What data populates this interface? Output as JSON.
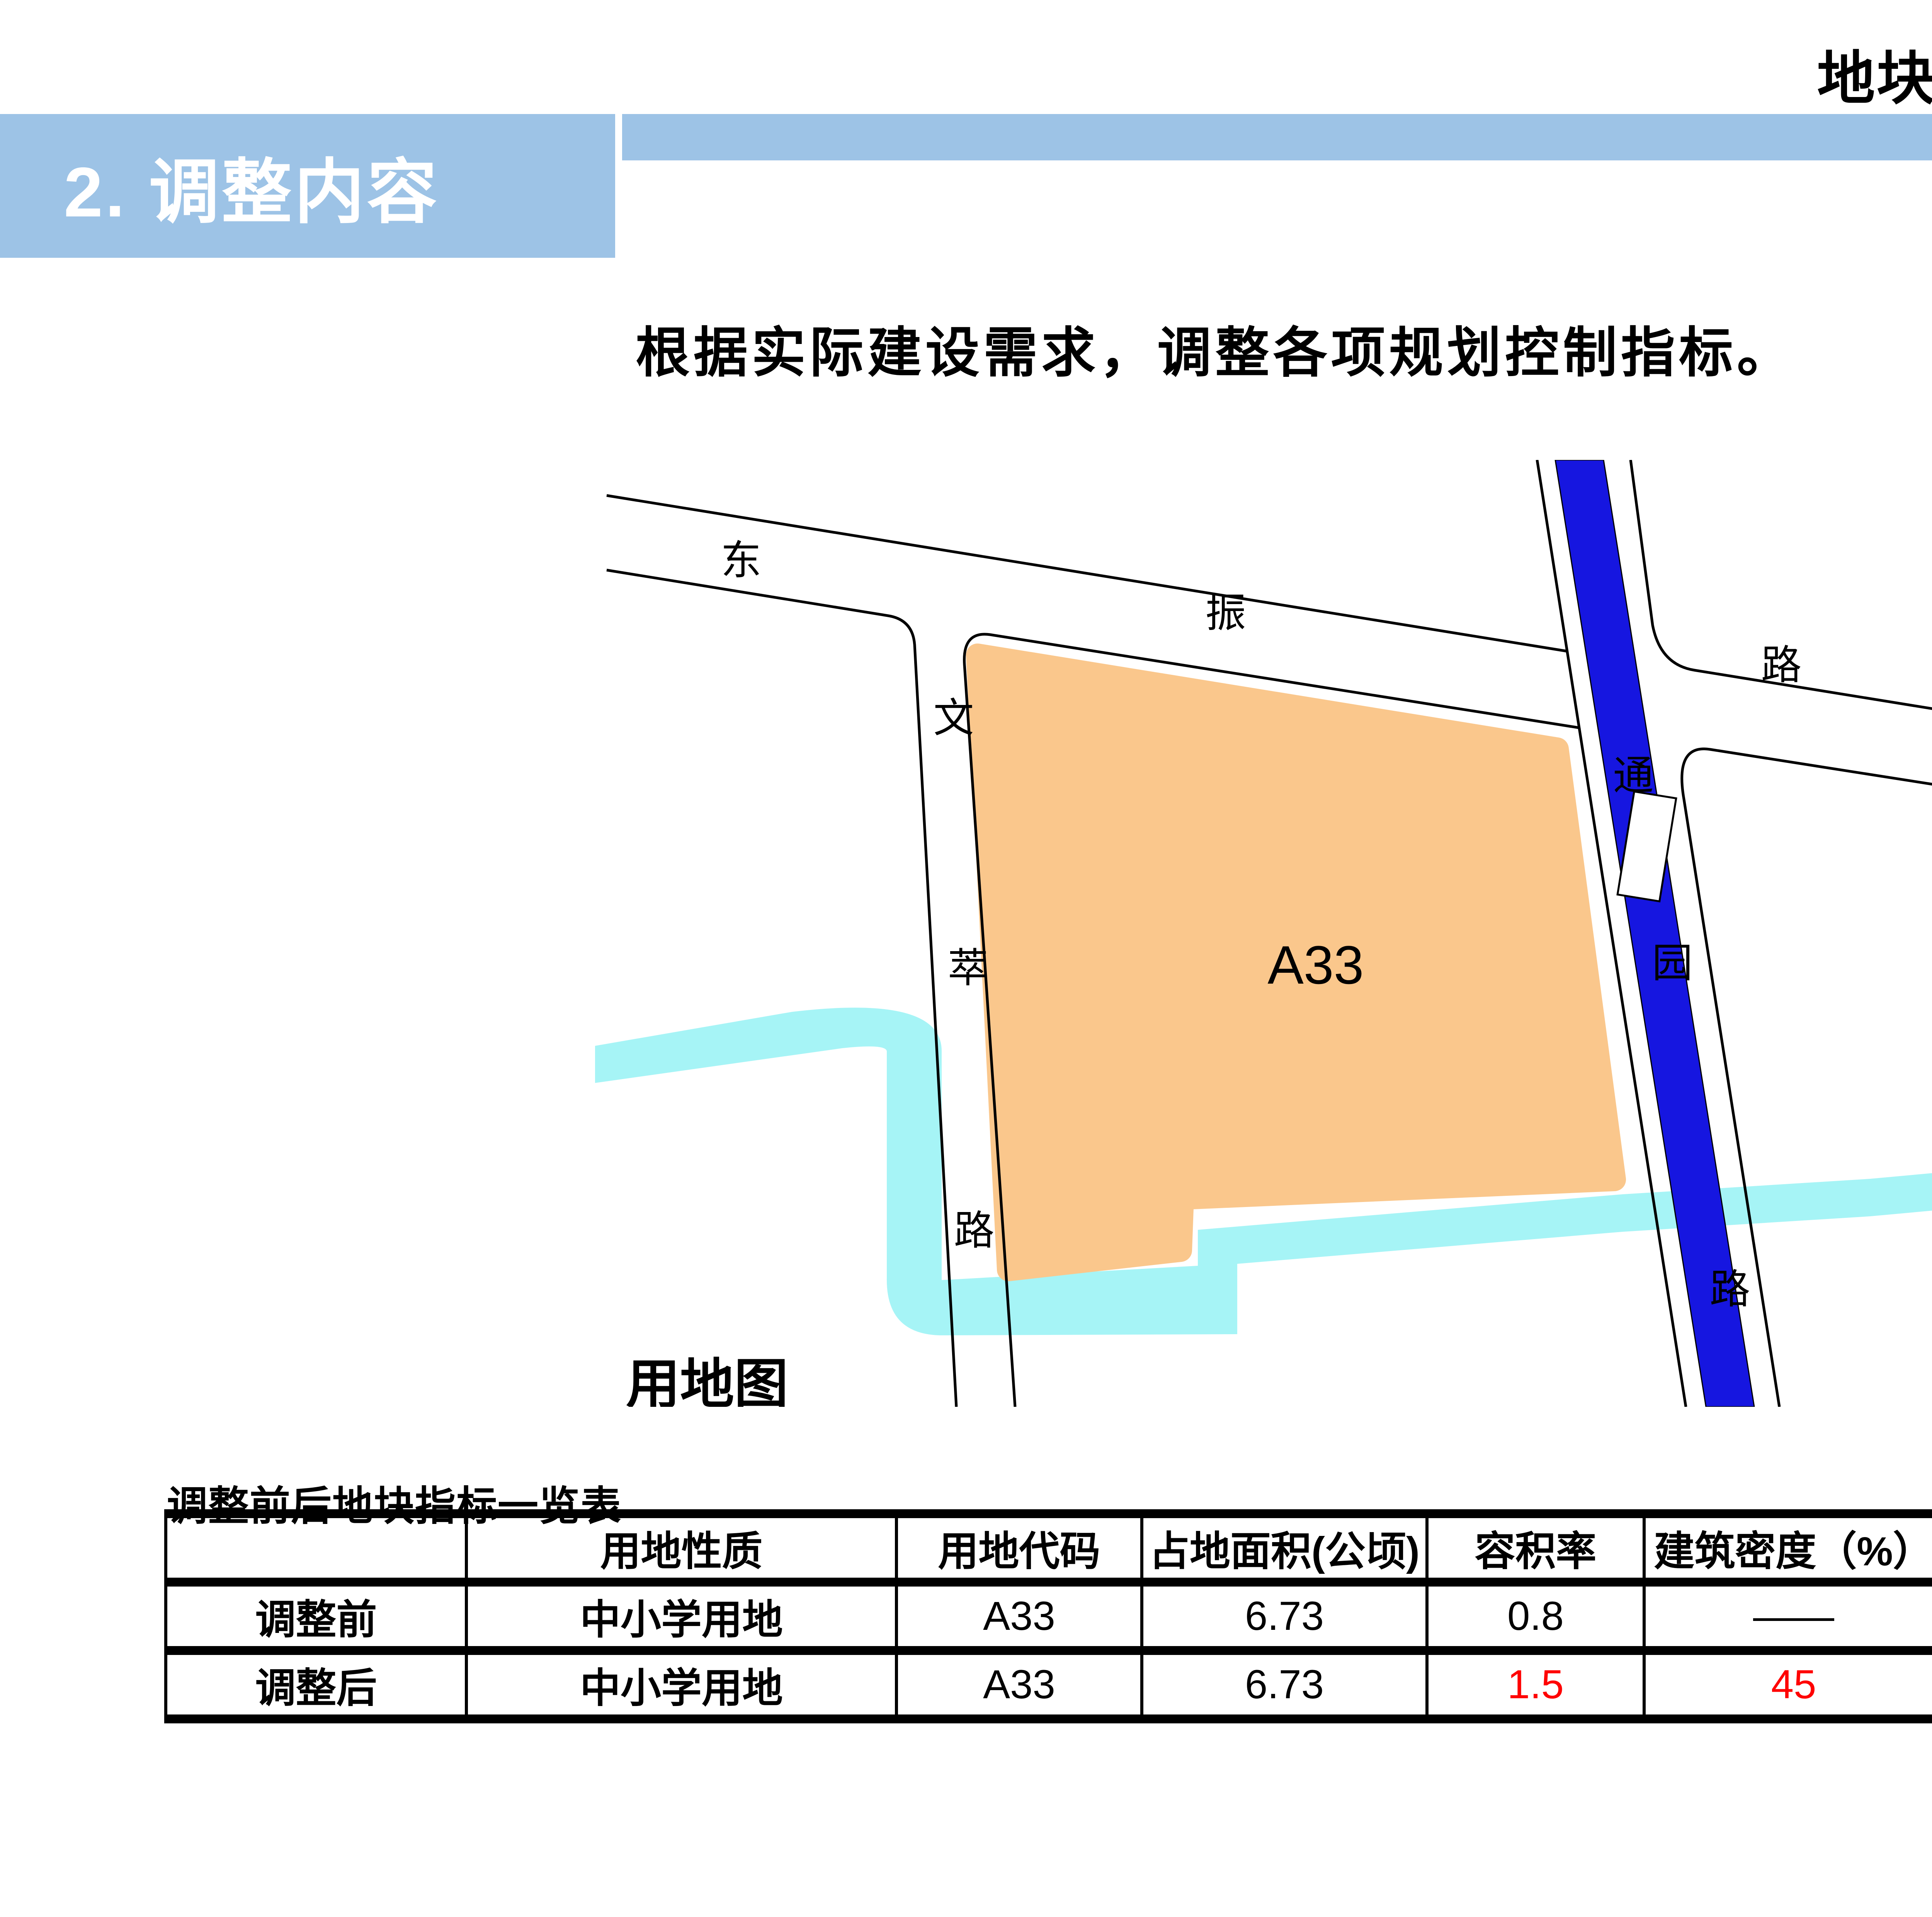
{
  "header": {
    "title": "地块6：东振路南、通园路西地块"
  },
  "section": {
    "label": "2. 调整内容"
  },
  "body": {
    "paragraph": "根据实际建设需求，调整各项规划控制指标。"
  },
  "map": {
    "caption": "用地图",
    "plot_label": "A33",
    "roads": {
      "dongzhen": [
        "东",
        "振",
        "路"
      ],
      "wencui": [
        "文",
        "萃",
        "路"
      ],
      "tongyuan": [
        "通",
        "园",
        "路"
      ]
    },
    "colors": {
      "plot_fill": "#FAC78C",
      "river_fill": "#A6F4F6",
      "canal_fill": "#1616E0",
      "road_line": "#000000"
    }
  },
  "table": {
    "title": "调整前后地块指标一览表",
    "columns": [
      "",
      "用地性质",
      "用地代码",
      "占地面积(公顷)",
      "容积率",
      "建筑密度（%）",
      "建筑限高（米）",
      "绿化率（%）"
    ],
    "rows": [
      {
        "label": "调整前",
        "values": [
          "中小学用地",
          "A33",
          "6.73",
          "0.8",
          "——",
          "——",
          "——"
        ]
      },
      {
        "label": "调整后",
        "values": [
          "中小学用地",
          "A33",
          "6.73",
          "1.5",
          "45",
          "50",
          "20"
        ]
      }
    ],
    "highlight_color": "#FF0000"
  },
  "page": {
    "number": "19"
  },
  "theme": {
    "banner_blue": "#9DC3E6",
    "page_number_color": "#8A8A8A"
  }
}
